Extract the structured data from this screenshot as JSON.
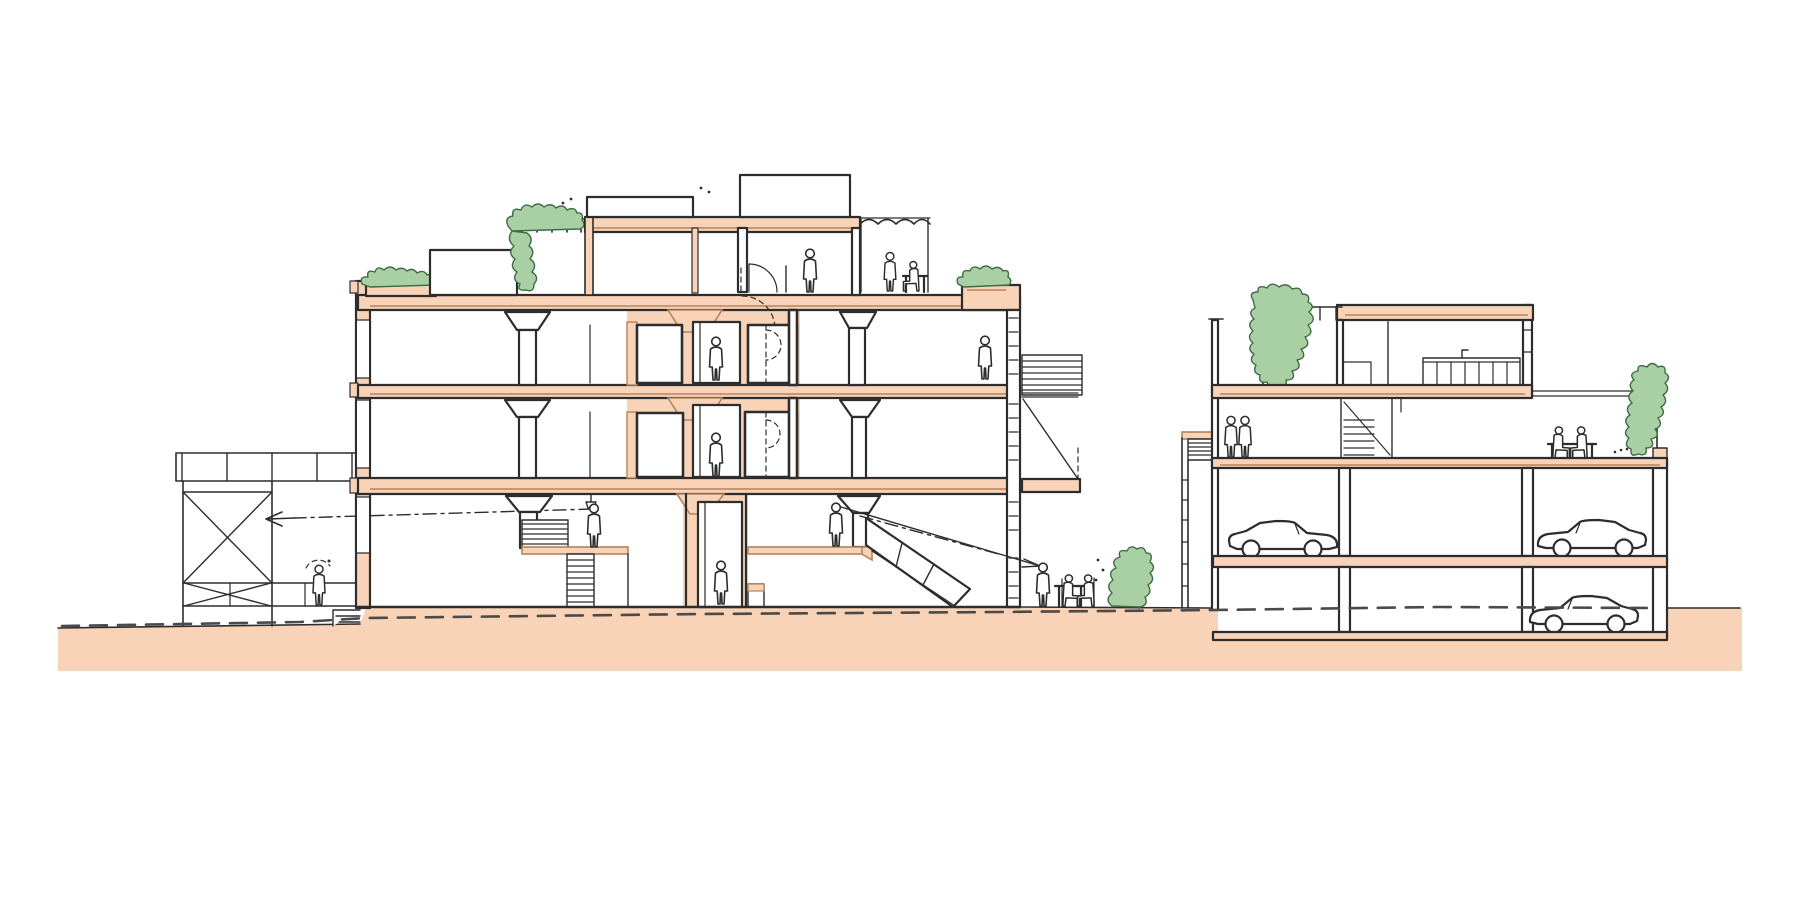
{
  "meta": {
    "title": "Hand-drawn architectural cross-section: a five-storey mixed-use building with set-back penthouse and roof terraces, a scaffold pergola at left, a courtyard cafe, and a neighbouring block with roof garden, kitchen level and two parking decks with cars",
    "drawing_type": "sectional sketch, ink line work with flat colour washes",
    "canvas": {
      "width": 1800,
      "height": 900
    }
  },
  "colors": {
    "paper": "#ffffff",
    "peach": "#f8d3b8",
    "brown": "#b5835a",
    "green": "#a9cfa4",
    "green_dark": "#3f6b45",
    "ink": "#2d2d2d",
    "dash": "#4a4a4a"
  },
  "scene": {
    "ground": {
      "label": "earth / street band cut in section",
      "features": [
        "flat peach fill",
        "dashed grade line running full width",
        "hand-drawn top edge"
      ]
    },
    "scaffold": {
      "label": "light steel walkway structure with X-bracing",
      "features": [
        "top walkway band with posts",
        "cross braces",
        "figure sketched with dashed outline",
        "sight arrow pointing left into structure"
      ]
    },
    "left_building": {
      "label": "main five-storey building",
      "levels": [
        "ground hall with split mezzanines, side stairs, escalator and lift",
        "second floor with lift lobby and mushroom columns",
        "third floor with lift lobby and mushroom columns",
        "set-back penthouse with door, table group and awning",
        "roof terraces with planters, shed, pergola greenery and roof boxes"
      ],
      "core": "central peach service core with elevator and stair door swings",
      "right_side": [
        "hatched service wall",
        "louvre box",
        "cable-hung balcony"
      ],
      "sight_lines": [
        "dash-dot line to left arrow",
        "solid and dash-dot lines to cafe arrow"
      ]
    },
    "courtyard": {
      "label": "outdoor cafe terrace between buildings",
      "features": [
        "standing figure",
        "table with two seated figures",
        "shrub on post"
      ]
    },
    "right_building": {
      "label": "neighbouring four-level block over two parking decks",
      "levels": [
        "roof terrace with railing and large cascading tree",
        "top floor with kitchen counter",
        "mid level with internal stair, two figures and balcony table at right",
        "parking deck with two cars",
        "basement parking with one car below the grade line"
      ],
      "annex": "small entry stair annex against the left wall",
      "balcony": "right balcony with table group, dotted leader and green trellis"
    },
    "counts": {
      "people": 17,
      "cars": 3,
      "planting_clusters": 7
    }
  }
}
